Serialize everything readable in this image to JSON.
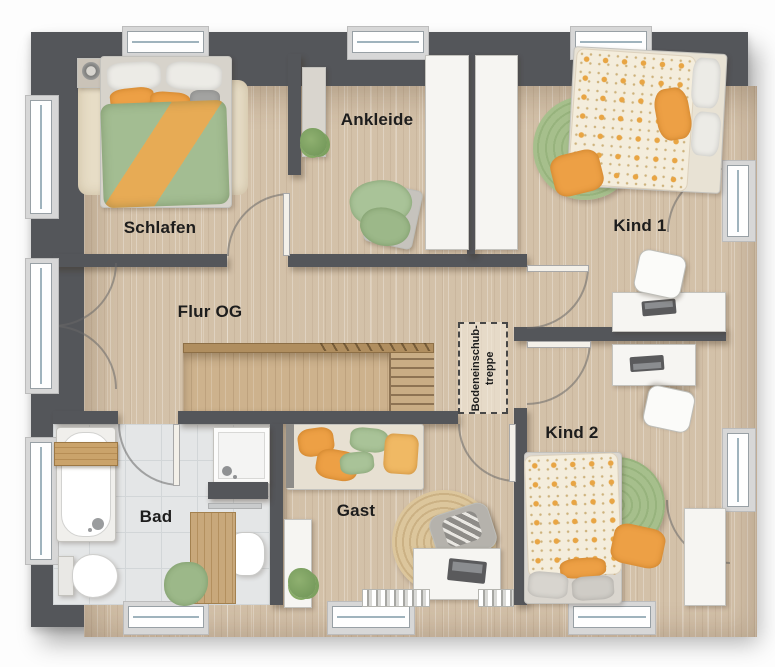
{
  "rooms": {
    "schlafen": {
      "label": "Schlafen"
    },
    "ankleide": {
      "label": "Ankleide"
    },
    "kind1": {
      "label": "Kind 1"
    },
    "kind2": {
      "label": "Kind 2"
    },
    "flur": {
      "label": "Flur OG"
    },
    "bad": {
      "label": "Bad"
    },
    "gast": {
      "label": "Gast"
    }
  },
  "annotations": {
    "attic_stairs": {
      "line1": "Bodeneinschub-",
      "line2": "treppe"
    }
  },
  "colors": {
    "wall": "#54565a",
    "floor_wood": "#d9c8b1",
    "floor_tile": "#e4e6e7",
    "stair_wood": "#cdb28d",
    "accent_orange": "#eda045",
    "accent_green": "#a9c398",
    "furniture_white": "#f6f5f2"
  }
}
